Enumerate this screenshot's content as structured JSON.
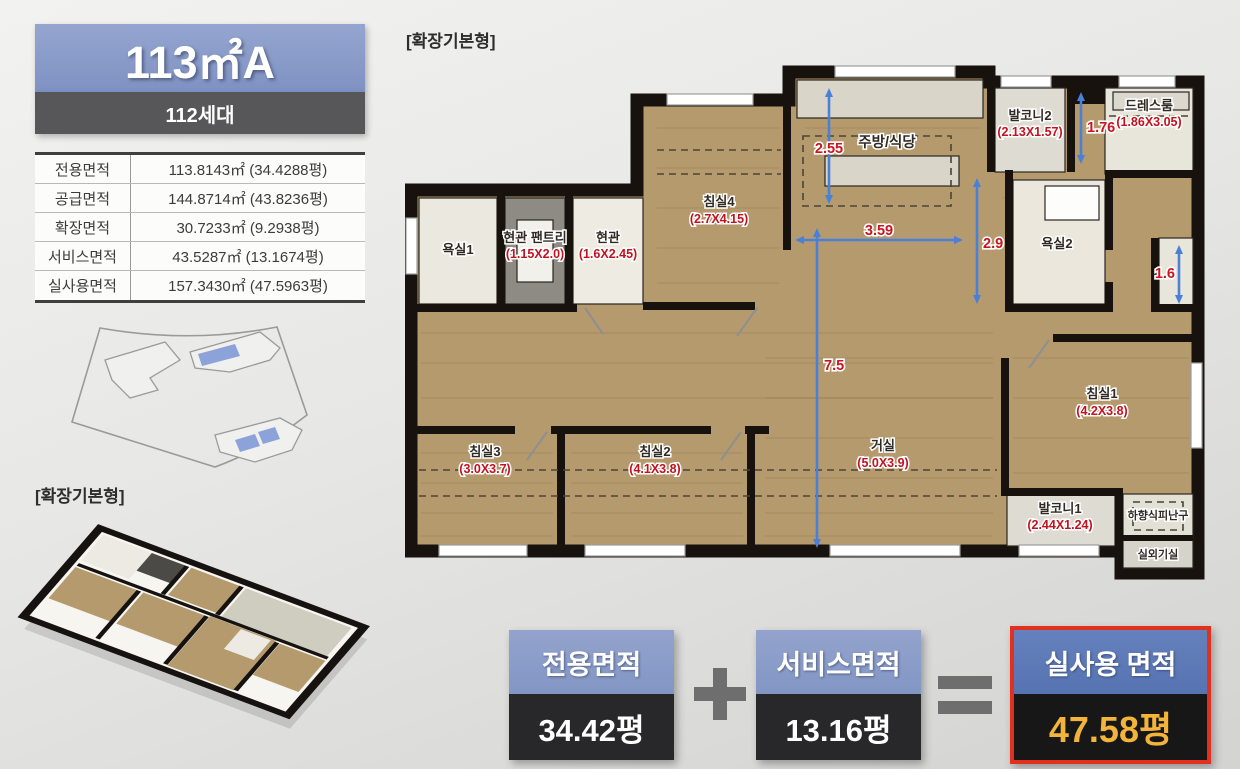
{
  "left_panel": {
    "title": "113㎡A",
    "units": "112세대",
    "area_table": {
      "rows": [
        {
          "label": "전용면적",
          "value": "113.8143㎡ (34.4288평)"
        },
        {
          "label": "공급면적",
          "value": "144.8714㎡ (43.8236평)"
        },
        {
          "label": "확장면적",
          "value": "30.7233㎡ (9.2938평)"
        },
        {
          "label": "서비스면적",
          "value": "43.5287㎡ (13.1674평)"
        },
        {
          "label": "실사용면적",
          "value": "157.3430㎡ (47.5963평)"
        }
      ]
    },
    "iso_label": "[확장기본형]"
  },
  "plan": {
    "label": "[확장기본형]",
    "rooms": [
      {
        "name": "욕실1",
        "dims": ""
      },
      {
        "name": "현관 팬트리",
        "dims": "(1.15X2.0)"
      },
      {
        "name": "현관",
        "dims": "(1.6X2.45)"
      },
      {
        "name": "침실4",
        "dims": "(2.7X4.15)"
      },
      {
        "name": "주방/식당",
        "dims": ""
      },
      {
        "name": "발코니2",
        "dims": "(2.13X1.57)"
      },
      {
        "name": "드레스룸",
        "dims": "(1.86X3.05)"
      },
      {
        "name": "욕실2",
        "dims": ""
      },
      {
        "name": "침실1",
        "dims": "(4.2X3.8)"
      },
      {
        "name": "거실",
        "dims": "(5.0X3.9)"
      },
      {
        "name": "침실2",
        "dims": "(4.1X3.8)"
      },
      {
        "name": "침실3",
        "dims": "(3.0X3.7)"
      },
      {
        "name": "발코니1",
        "dims": "(2.44X1.24)"
      },
      {
        "name": "하향식피난구",
        "dims": ""
      },
      {
        "name": "실외기실",
        "dims": ""
      }
    ],
    "dims": {
      "kitchen_h": "2.55",
      "hall_w": "3.59",
      "hall_h": "2.9",
      "living_h": "7.5",
      "balcony2_h": "1.76",
      "closet_h": "1.6"
    }
  },
  "summary": {
    "items": [
      {
        "title": "전용면적",
        "value": "34.42평"
      },
      {
        "title": "서비스면적",
        "value": "13.16평"
      },
      {
        "title": "실사용 면적",
        "value": "47.58평"
      }
    ],
    "operators": {
      "plus": "+",
      "equals": "="
    }
  },
  "colors": {
    "title_blue": "#8496c5",
    "units_gray": "#57575a",
    "floor_tan": "#b49a6d",
    "wall_black": "#17120d",
    "dim_arrow_blue": "#4a80d8",
    "dim_text_red": "#cc1420",
    "highlight_border_red": "#e2301f",
    "highlight_gold": "#f2b43a",
    "summary_dark": "#28282a"
  }
}
